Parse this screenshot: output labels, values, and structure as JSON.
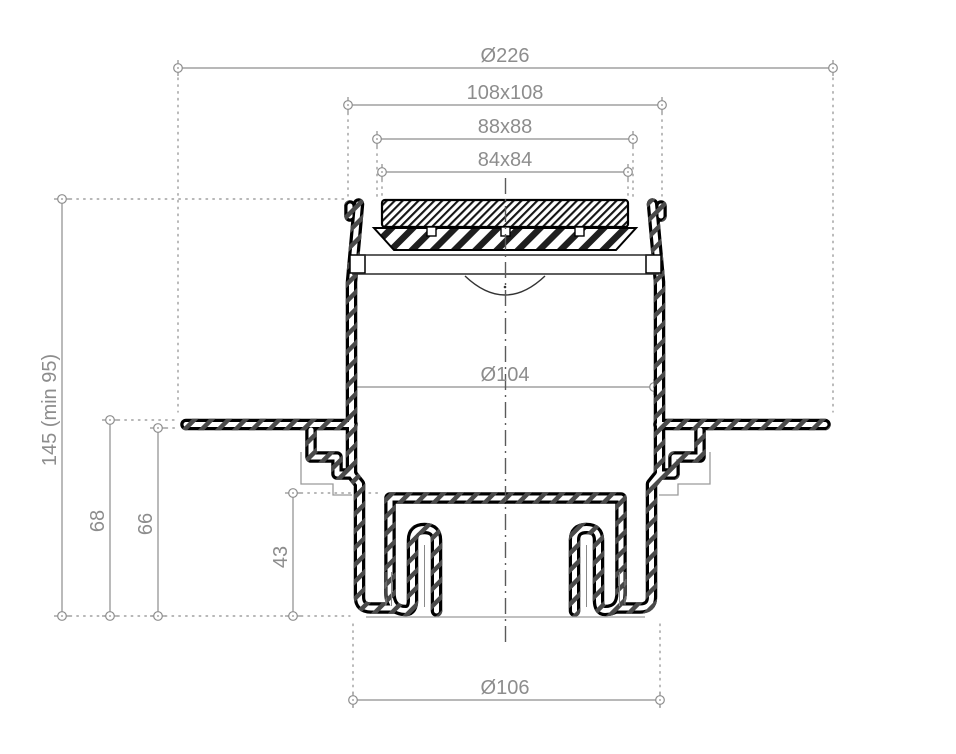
{
  "drawing": {
    "kind": "technical-cross-section",
    "labels": {
      "d226": "Ø226",
      "d108": "108x108",
      "d88": "88x88",
      "d84": "84x84",
      "d104": "Ø104",
      "d106": "Ø106",
      "d145": "145 (min 95)",
      "d68": "68",
      "d66": "66",
      "d43": "43"
    },
    "colors": {
      "outline": "#000000",
      "hatch": "#4a4a4a",
      "dimension": "#8d8d8d",
      "background": "#ffffff"
    }
  }
}
